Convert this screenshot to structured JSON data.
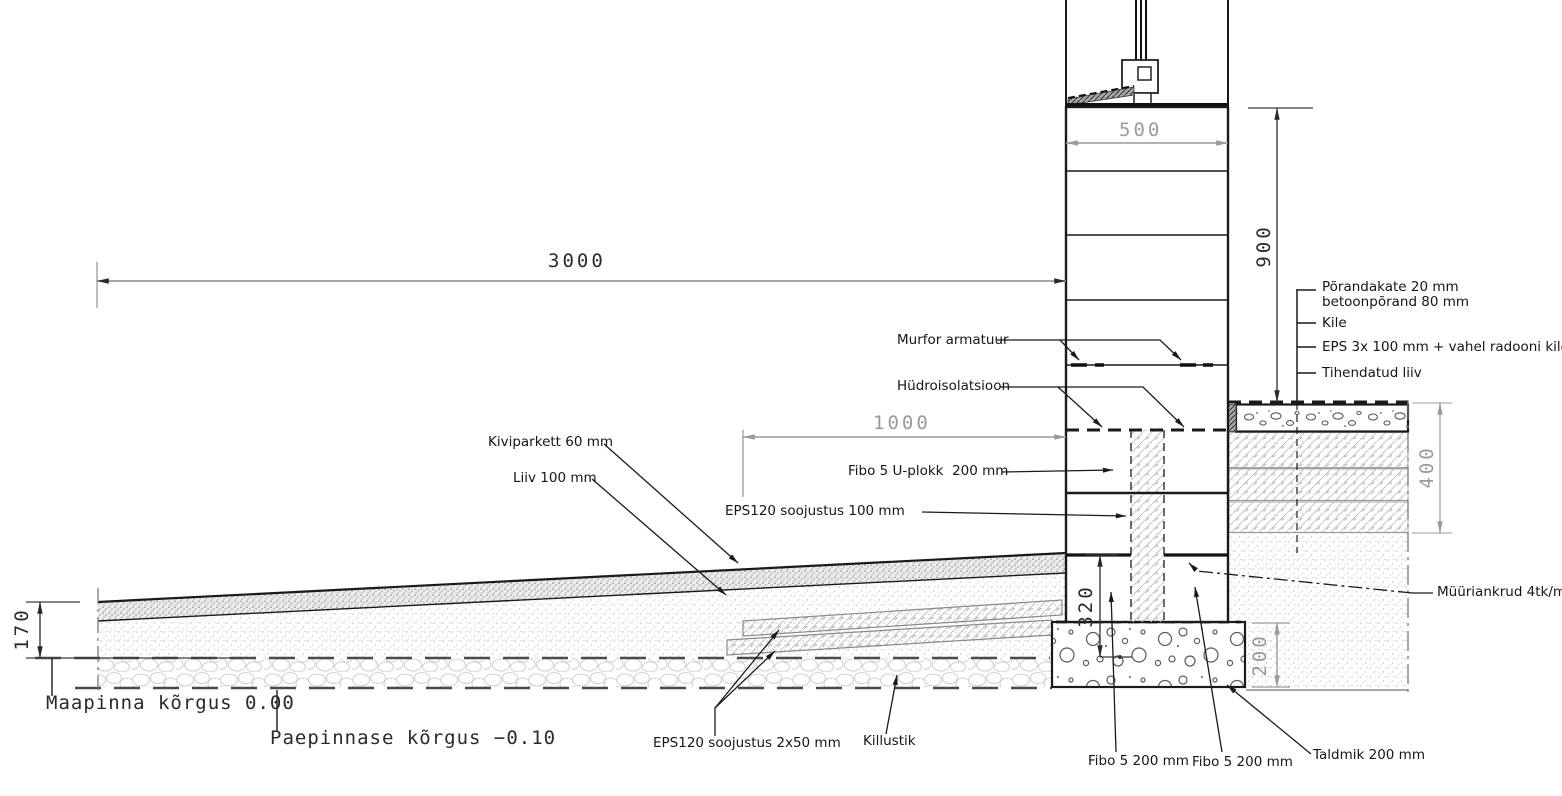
{
  "drawing_labels": {
    "murfor": "Murfor armatuur",
    "hydro": "Hüdroisolatsioon",
    "kiviparkett": "Kiviparkett 60 mm",
    "liiv": "Liiv 100 mm",
    "fibo_u_plokk": "Fibo 5 U-plokk  200 mm",
    "eps120_100": "EPS120 soojustus 100 mm",
    "muuriankrud": "Müüriankrud 4tk/m²",
    "eps120_2x50": "EPS120 soojustus 2x50 mm",
    "killustik": "Killustik",
    "fibo_left": "Fibo 5 200 mm",
    "fibo_right": "Fibo 5 200 mm",
    "taldmik": "Taldmik 200 mm",
    "maapind": "Maapinna kõrgus 0.00",
    "paepind": "Paepinnase kõrgus −0.10"
  },
  "floor_layers": {
    "items": [
      {
        "text": "Põrandakate 20 mm\nbetoonpõrand 80 mm"
      },
      {
        "text": "Kile"
      },
      {
        "text": "EPS 3x 100 mm + vahel radooni kile"
      },
      {
        "text": "Tihendatud liiv"
      }
    ]
  },
  "dimensions": {
    "d3000": "3000",
    "d500": "500",
    "d1000": "1000",
    "d900": "900",
    "d400": "400",
    "d320": "320",
    "d200": "200",
    "d170": "170"
  },
  "colors": {
    "line": "#1a1a1a",
    "dim_gray": "#9a9a9a"
  }
}
